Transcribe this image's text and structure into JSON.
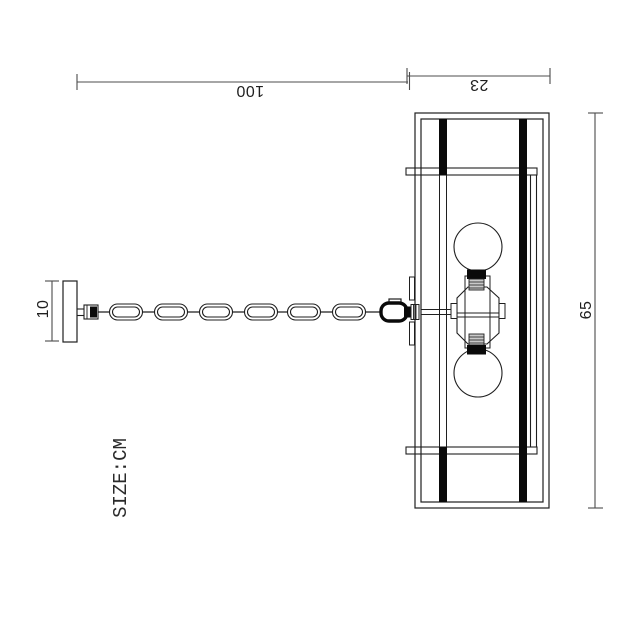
{
  "drawing": {
    "unit_label": "SIZE:CM",
    "dimensions": {
      "chain_length": "100",
      "frame_width": "23",
      "canopy_width": "10",
      "frame_length": "65"
    },
    "colors": {
      "line": "#1f1f1f",
      "dim_line": "#4c4c4c",
      "background": "#ffffff",
      "socket_rib": "#c9c9c9",
      "bar_fill": "#0a0a0a"
    }
  }
}
